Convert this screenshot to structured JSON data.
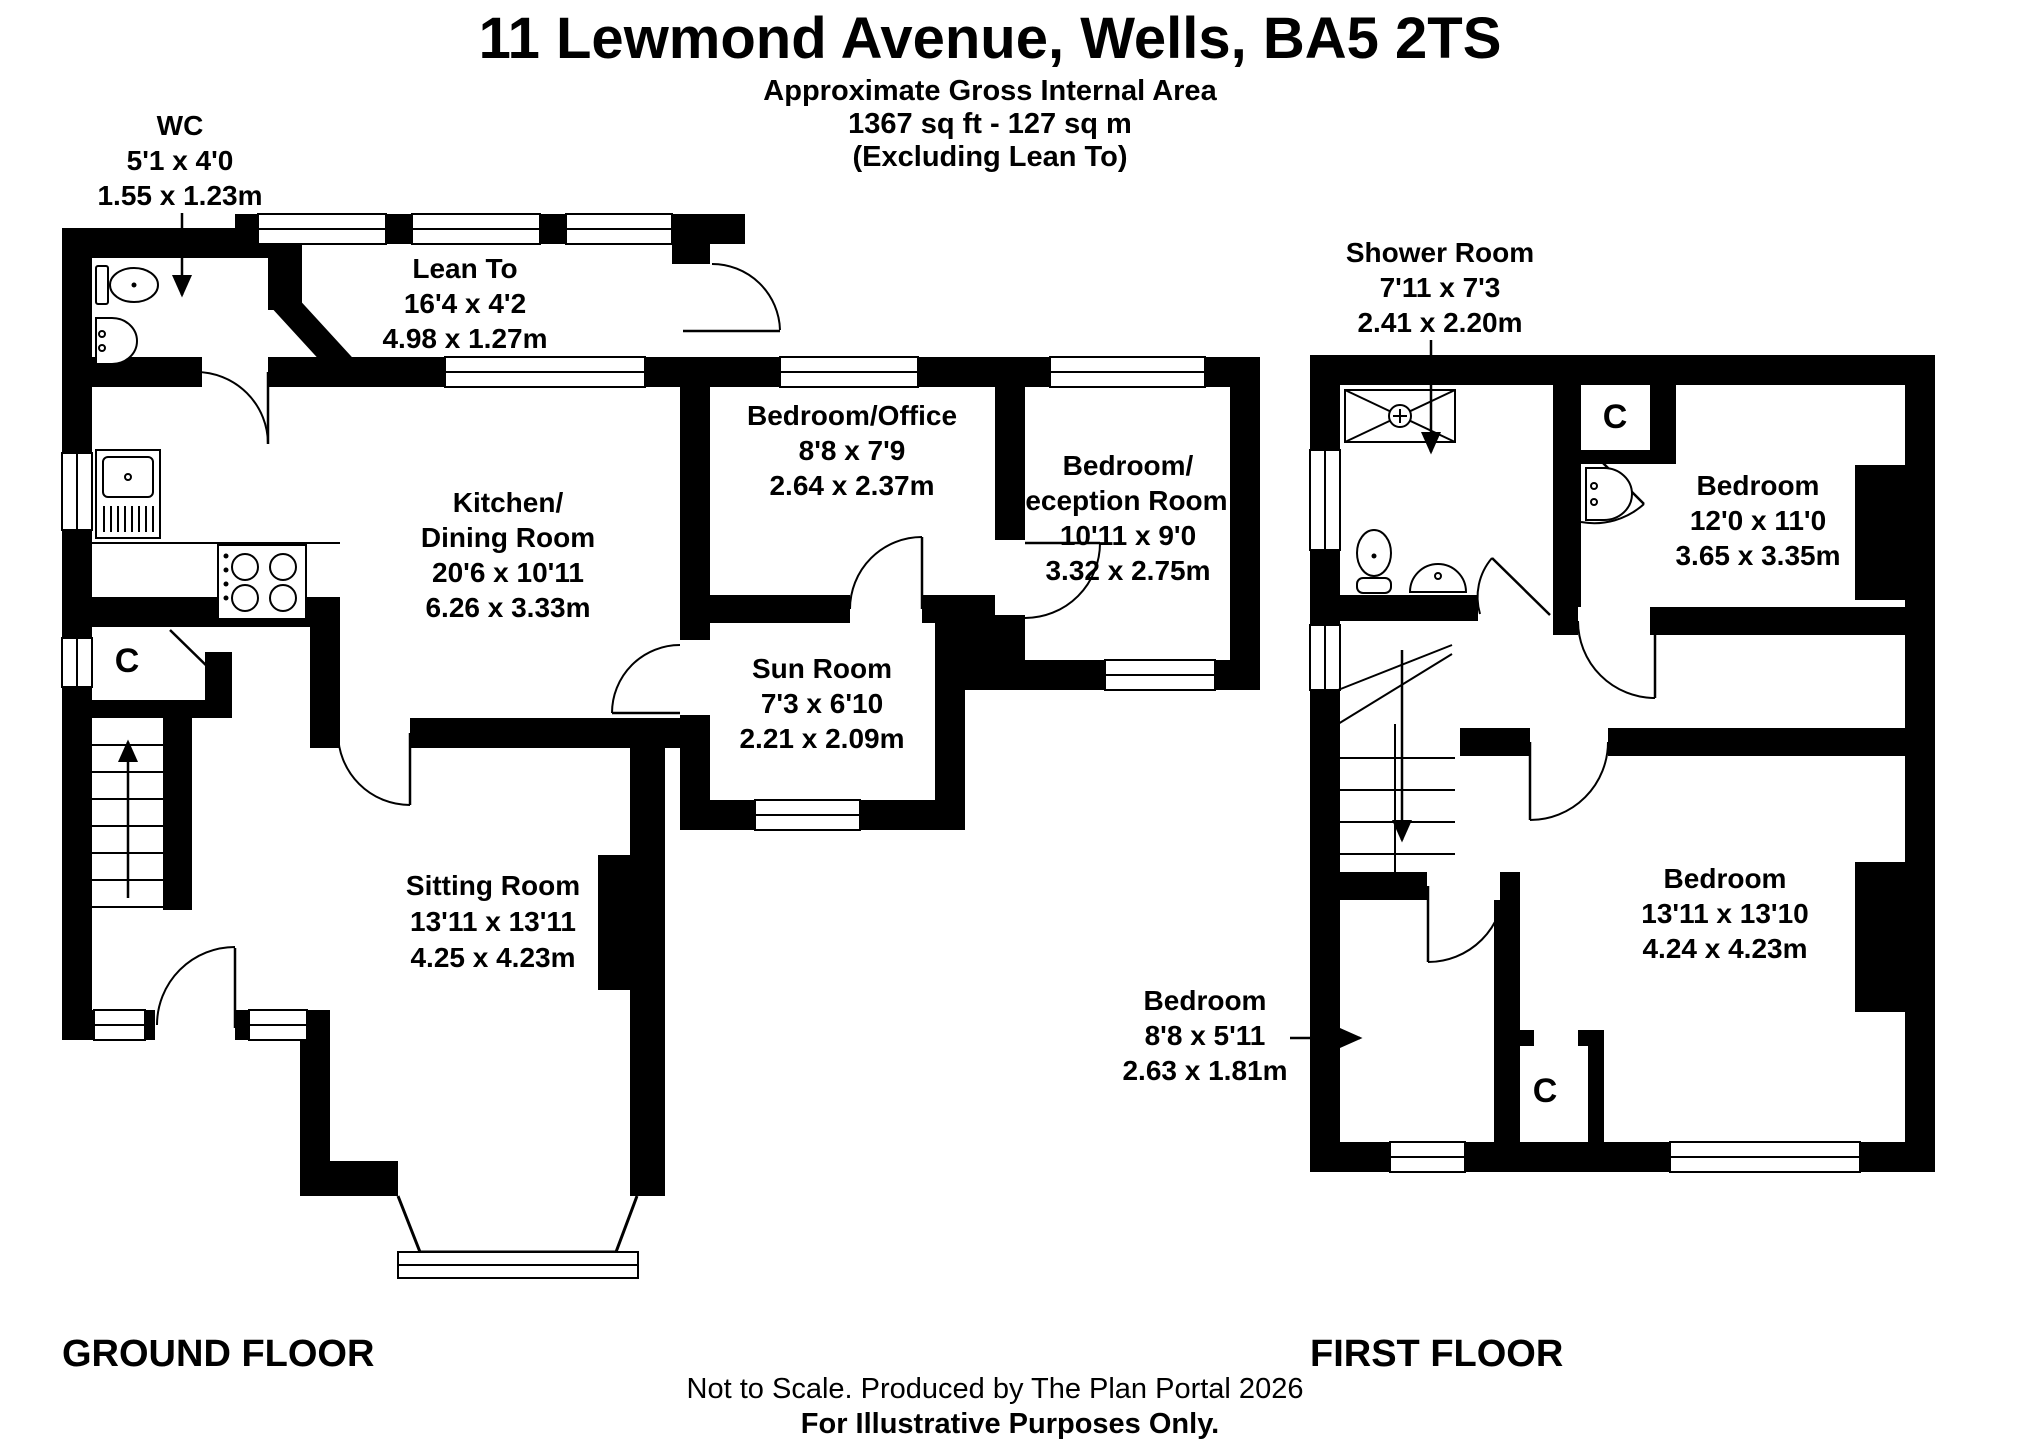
{
  "header": {
    "title": "11 Lewmond Avenue, Wells, BA5 2TS",
    "subtitle": "Approximate Gross Internal Area",
    "area": "1367 sq ft - 127 sq m",
    "exclusion": "(Excluding Lean To)"
  },
  "ground_floor": {
    "label": "GROUND FLOOR",
    "cupboard": "C",
    "rooms": {
      "wc": {
        "name": "WC",
        "imperial": "5'1 x 4'0",
        "metric": "1.55 x 1.23m"
      },
      "lean_to": {
        "name": "Lean To",
        "imperial": "16'4 x 4'2",
        "metric": "4.98 x 1.27m"
      },
      "kitchen": {
        "name_line1": "Kitchen/",
        "name_line2": "Dining Room",
        "imperial": "20'6 x 10'11",
        "metric": "6.26 x 3.33m"
      },
      "bedroom_office": {
        "name": "Bedroom/Office",
        "imperial": "8'8 x 7'9",
        "metric": "2.64 x 2.37m"
      },
      "bedroom_reception": {
        "name_line1": "Bedroom/",
        "name_line2": "Reception Room 2",
        "imperial": "10'11 x 9'0",
        "metric": "3.32 x 2.75m"
      },
      "sun_room": {
        "name": "Sun Room",
        "imperial": "7'3 x 6'10",
        "metric": "2.21 x 2.09m"
      },
      "sitting_room": {
        "name": "Sitting Room",
        "imperial": "13'11 x 13'11",
        "metric": "4.25 x 4.23m"
      }
    }
  },
  "first_floor": {
    "label": "FIRST FLOOR",
    "cupboard_top": "C",
    "cupboard_bottom": "C",
    "rooms": {
      "shower_room": {
        "name": "Shower Room",
        "imperial": "7'11 x 7'3",
        "metric": "2.41 x 2.20m"
      },
      "bedroom_front": {
        "name": "Bedroom",
        "imperial": "12'0 x 11'0",
        "metric": "3.65 x 3.35m"
      },
      "bedroom_back": {
        "name": "Bedroom",
        "imperial": "13'11 x 13'10",
        "metric": "4.24 x 4.23m"
      },
      "bedroom_small": {
        "name": "Bedroom",
        "imperial": "8'8 x 5'11",
        "metric": "2.63 x 1.81m"
      }
    }
  },
  "footer": {
    "line1": "Not to Scale. Produced by The Plan Portal 2026",
    "line2": "For Illustrative Purposes Only."
  }
}
